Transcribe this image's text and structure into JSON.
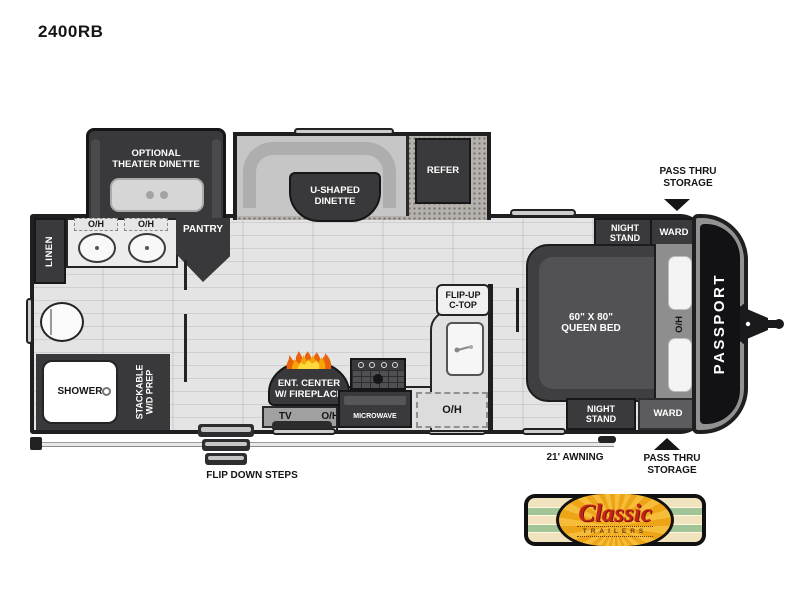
{
  "title": "2400RB",
  "floorplan": {
    "theater_dinette_label": "OPTIONAL\nTHEATER DINETTE",
    "u_dinette_label": "U-SHAPED\nDINETTE",
    "refer_label": "REFER",
    "linen_label": "LINEN",
    "oh_label": "O/H",
    "pantry_label": "PANTRY",
    "shower_label": "SHOWER",
    "wd_prep_label": "STACKABLE\nW/D PREP",
    "ent_center_label": "ENT. CENTER\nW/ FIREPLACE",
    "tv_label": "TV",
    "microwave_label": "MICROWAVE",
    "flip_up_ctop_label": "FLIP-UP\nC-TOP",
    "night_stand_top_label": "NIGHT\nSTAND",
    "ward_top_label": "WARD",
    "queen_bed_label": "60\" X 80\"\nQUEEN BED",
    "night_stand_bottom_label": "NIGHT\nSTAND",
    "ward_bottom_label": "WARD",
    "brand_side_label": "PASSPORT"
  },
  "annotations": {
    "pass_thru_top": "PASS THRU\nSTORAGE",
    "pass_thru_bottom": "PASS THRU\nSTORAGE",
    "awning_label": "21' AWNING",
    "steps_label": "FLIP DOWN STEPS"
  },
  "logo": {
    "name": "Classic",
    "sub": "TRAILERS"
  },
  "colors": {
    "cabinet_dark": "#3a3a3c",
    "wall": "#1f1f21",
    "floor": "#e4e4e4",
    "slide_floor": "#b5b2ad",
    "logo_red": "#c3231a",
    "logo_green": "#a3c497",
    "logo_yellow": "#f6bd3b",
    "flame_orange": "#e8630c"
  }
}
